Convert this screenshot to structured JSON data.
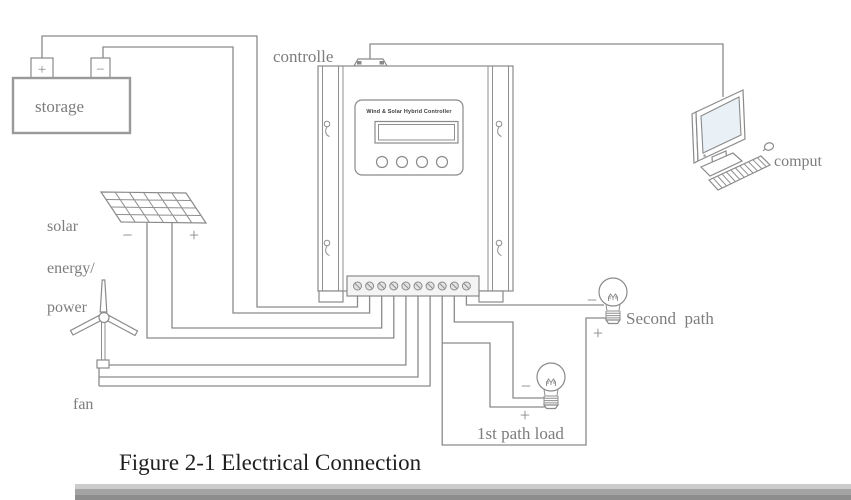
{
  "figure": {
    "caption": "Figure 2-1 Electrical Connection"
  },
  "labels": {
    "storage": "storage",
    "controller": "controlle",
    "solar_line1": "solar",
    "solar_line2": "energy/",
    "solar_line3": "power",
    "fan": "fan",
    "computer": "comput",
    "second_path": "Second  path",
    "first_path_load": "1st path load",
    "plus": "+",
    "minus": "−"
  },
  "controller": {
    "panel_title": "Wind & Solar Hybrid Controller",
    "button_count": 4,
    "terminal_count": 10
  },
  "colors": {
    "wire": "#8a8a8a",
    "label_text": "#7d7d7d",
    "caption_text": "#1f1f1f",
    "monitor_screen": "#e9f1f7",
    "background": "#ffffff"
  }
}
